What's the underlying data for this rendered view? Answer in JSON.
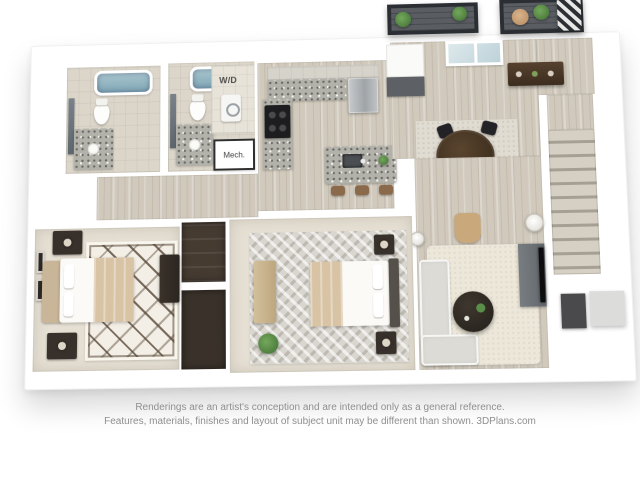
{
  "page": {
    "background": "#ffffff",
    "disclaimer_line1": "Renderings are an artist's conception and are intended only as a general reference.",
    "disclaimer_line2": "Features, materials, finishes and layout of subject unit may be different than shown. 3DPlans.com"
  },
  "floor_plan": {
    "kind": "3D isometric apartment floor plan rendering",
    "labels": {
      "laundry": "W/D",
      "mechanical": "Mech."
    },
    "rooms": [
      "bathroom 1",
      "bathroom 2",
      "laundry closet",
      "mechanical closet",
      "kitchen",
      "dining area",
      "living area",
      "balcony",
      "bedroom 1",
      "bedroom 2",
      "closets",
      "hallway",
      "entry stairs"
    ],
    "colors": {
      "wood_floor": "#d0c9bc",
      "carpet": "#e6e0d4",
      "bath_tile": "#dcd6ca",
      "granite": "#b3b2aa",
      "closet_dark": "#453b31",
      "balcony_deck": "#5a5e63",
      "railing": "#2b2f33",
      "tub": "#8fb0bd",
      "sofa": "#dcdbd5",
      "cream_rug": "#ece7d9",
      "chevron_rug": "#d9d6cf",
      "blanket_tan": "#d8c3a4",
      "plant_green": "#5a8f4a",
      "text_gray": "#8f8f8f"
    }
  }
}
